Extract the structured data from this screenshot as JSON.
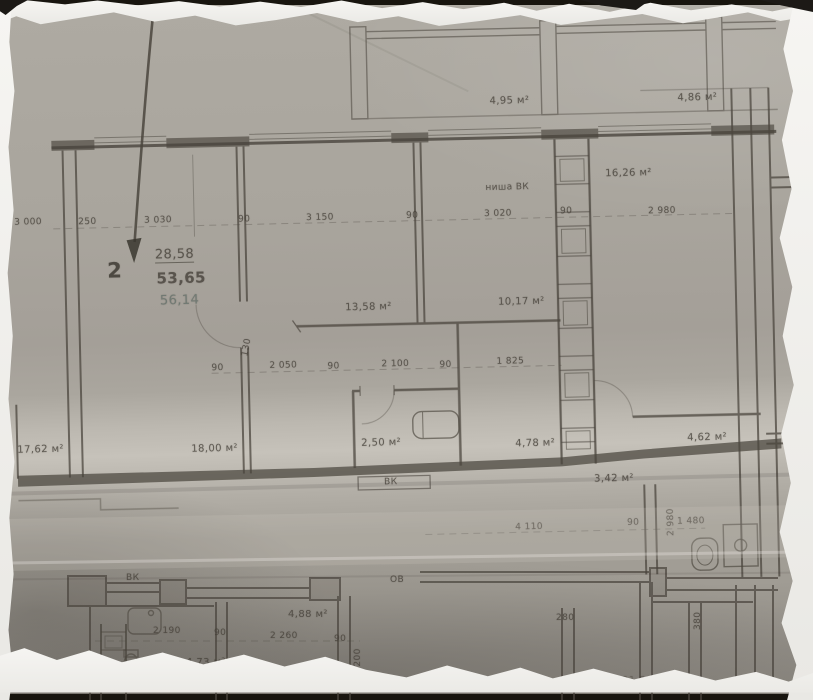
{
  "apartment_callout": {
    "number": "2",
    "area_living": "28,58",
    "area_total": "53,65",
    "area_with_balcony": "56,14"
  },
  "room_areas": {
    "balcony_top": "4,95 м²",
    "balcony_top_right": "4,86 м²",
    "room_right": "16,26 м²",
    "room_center": "13,58 м²",
    "room_small": "10,17 м²",
    "room_left_partial": "17,62 м²",
    "room_left": "18,00 м²",
    "bathroom": "2,50 м²",
    "hallway": "4,78 м²",
    "room_right_small": "4,62 м²",
    "storage": "3,42 м²",
    "lower_room_a": "4,88 м²",
    "lower_room_b": "4,73 м²",
    "lower_cut_a": "24,41",
    "lower_cut_b": "21,52"
  },
  "dimensions": {
    "top": [
      "3 000",
      "250",
      "3 030",
      "90",
      "3 150",
      "90",
      "3 020",
      "90",
      "2 980"
    ],
    "middle": [
      "90",
      "2 050",
      "90",
      "2 100",
      "90",
      "1 825"
    ],
    "door_width": "130",
    "corridor": [
      "4 110",
      "90",
      "1 480",
      "2 980"
    ],
    "lower": [
      "2 190",
      "90",
      "2 260",
      "90",
      "5 200",
      "280",
      "380"
    ]
  },
  "annotations": {
    "niche": "ниша ВК",
    "wc_upper": "ВК",
    "wc_lower": "ВК",
    "heating": "ОВ"
  }
}
